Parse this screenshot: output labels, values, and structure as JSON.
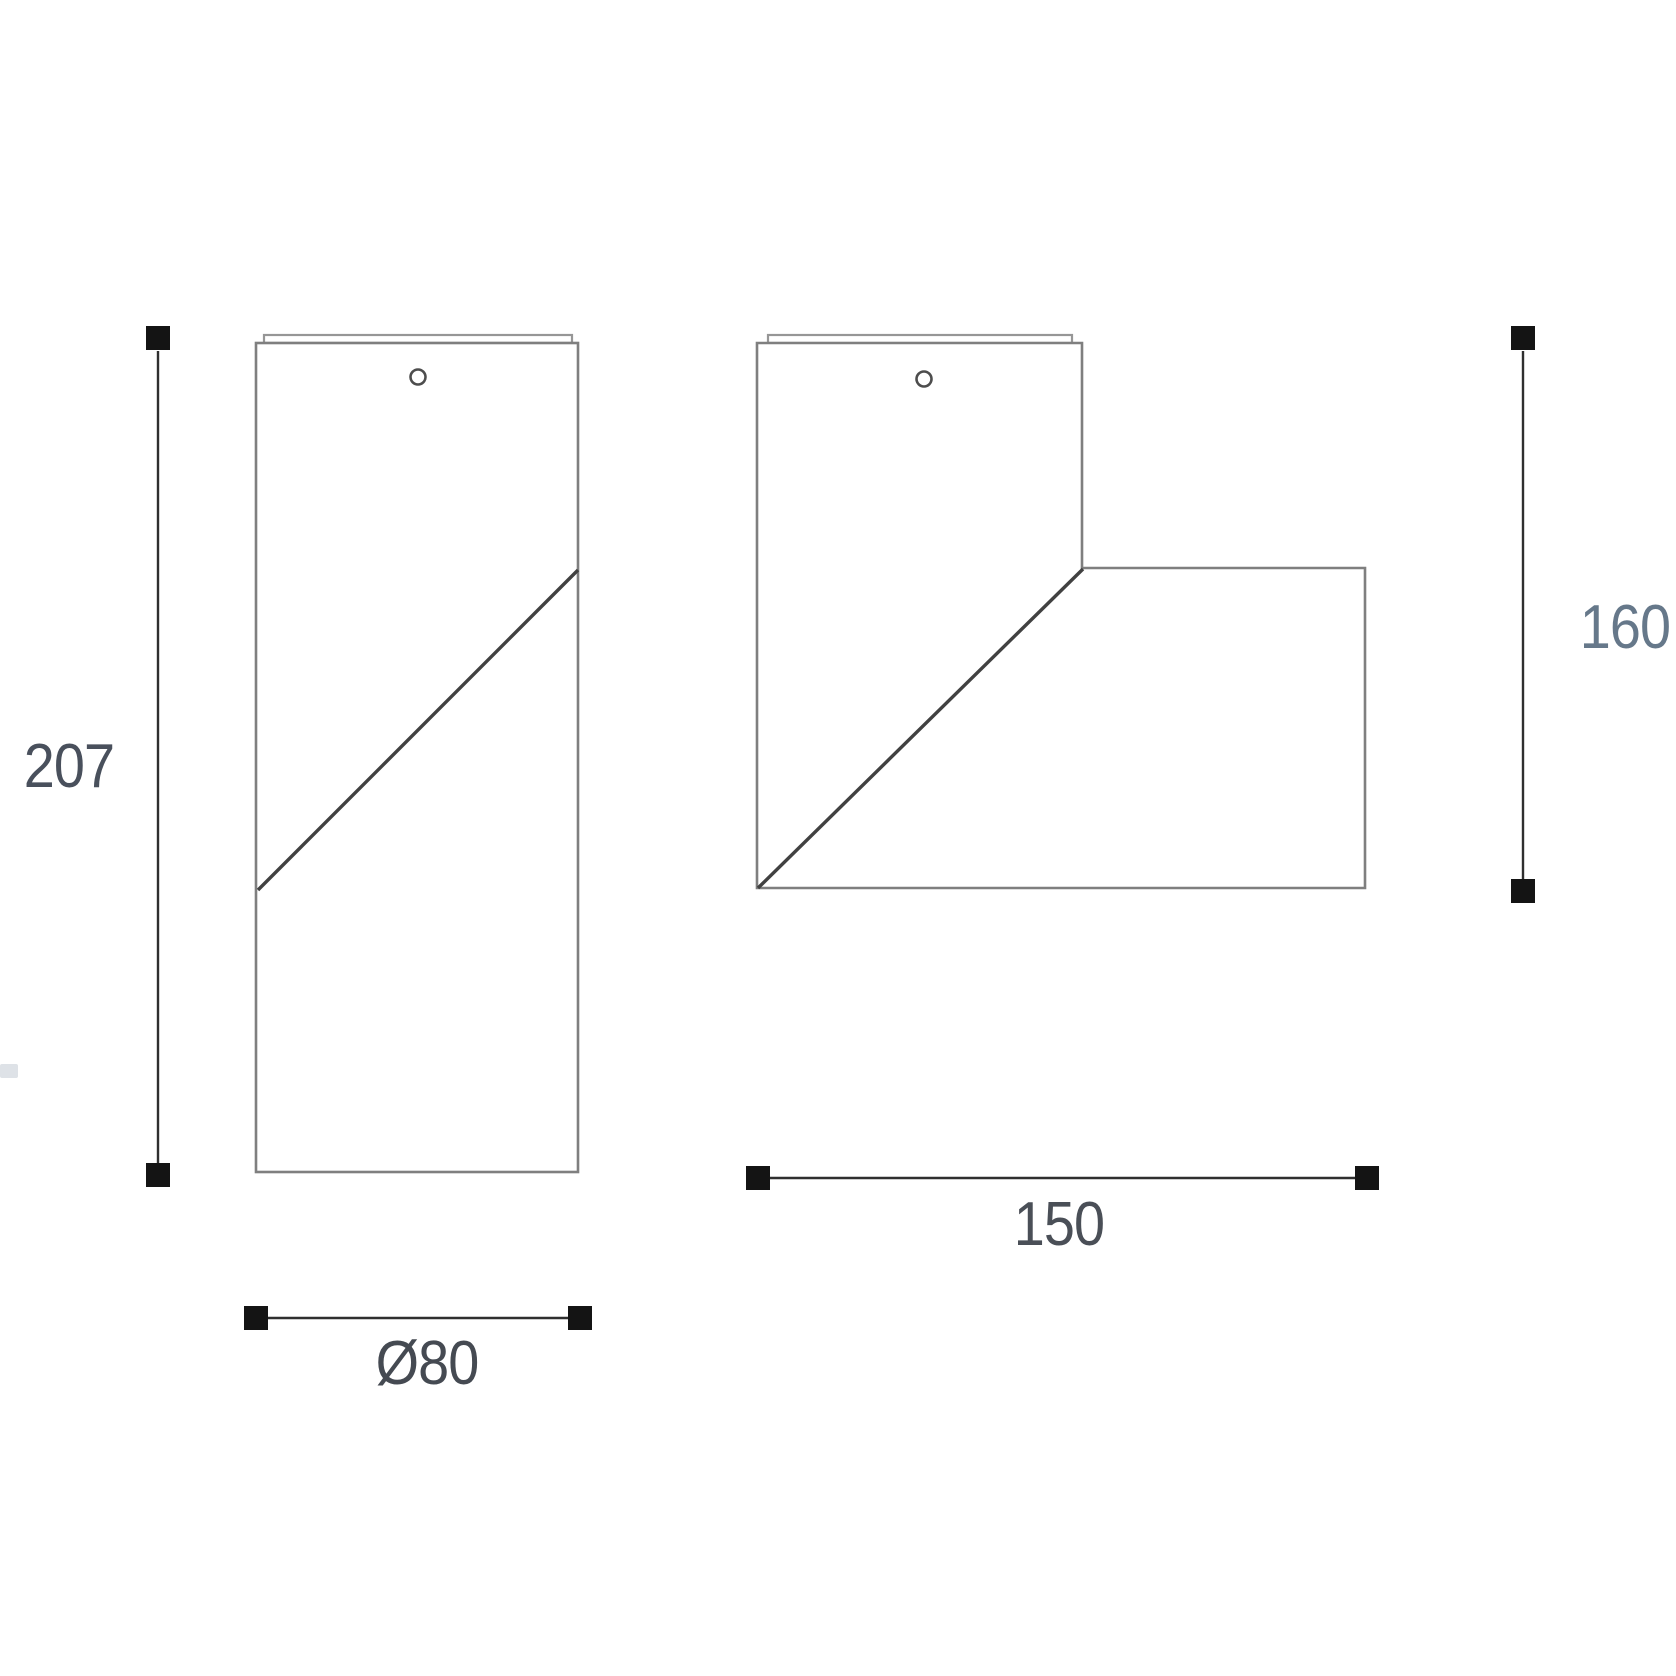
{
  "drawing": {
    "kind": "technical dimension drawing, two orthographic views of a spot light fixture",
    "background_color": "#ffffff",
    "views": {
      "front_view": {
        "shape": "tall rectangle with top mounting cap, small mounting hole, diagonal split line",
        "dimensions": {
          "height": {
            "value": "207",
            "color": "#49505c"
          },
          "diameter": {
            "value": "Ø80",
            "color": "#454a52"
          }
        }
      },
      "side_view": {
        "shape": "vertical body with horizontal head extension to the right, diagonal split line, top mounting cap, small mounting hole",
        "dimensions": {
          "height": {
            "value": "160",
            "color": "#66788a"
          },
          "width": {
            "value": "150",
            "color": "#4a4f57"
          }
        }
      }
    },
    "colors": {
      "body_outline": "#7f7f7f",
      "top_cap": "#969696",
      "split_line": "#414141",
      "dimension_line": "#2f2f2f",
      "dimension_marker": "#141414"
    },
    "icons": {
      "mounting_hole": "small circle near top center of each view",
      "dimension_marker": "solid black square at each dimension line end"
    }
  }
}
